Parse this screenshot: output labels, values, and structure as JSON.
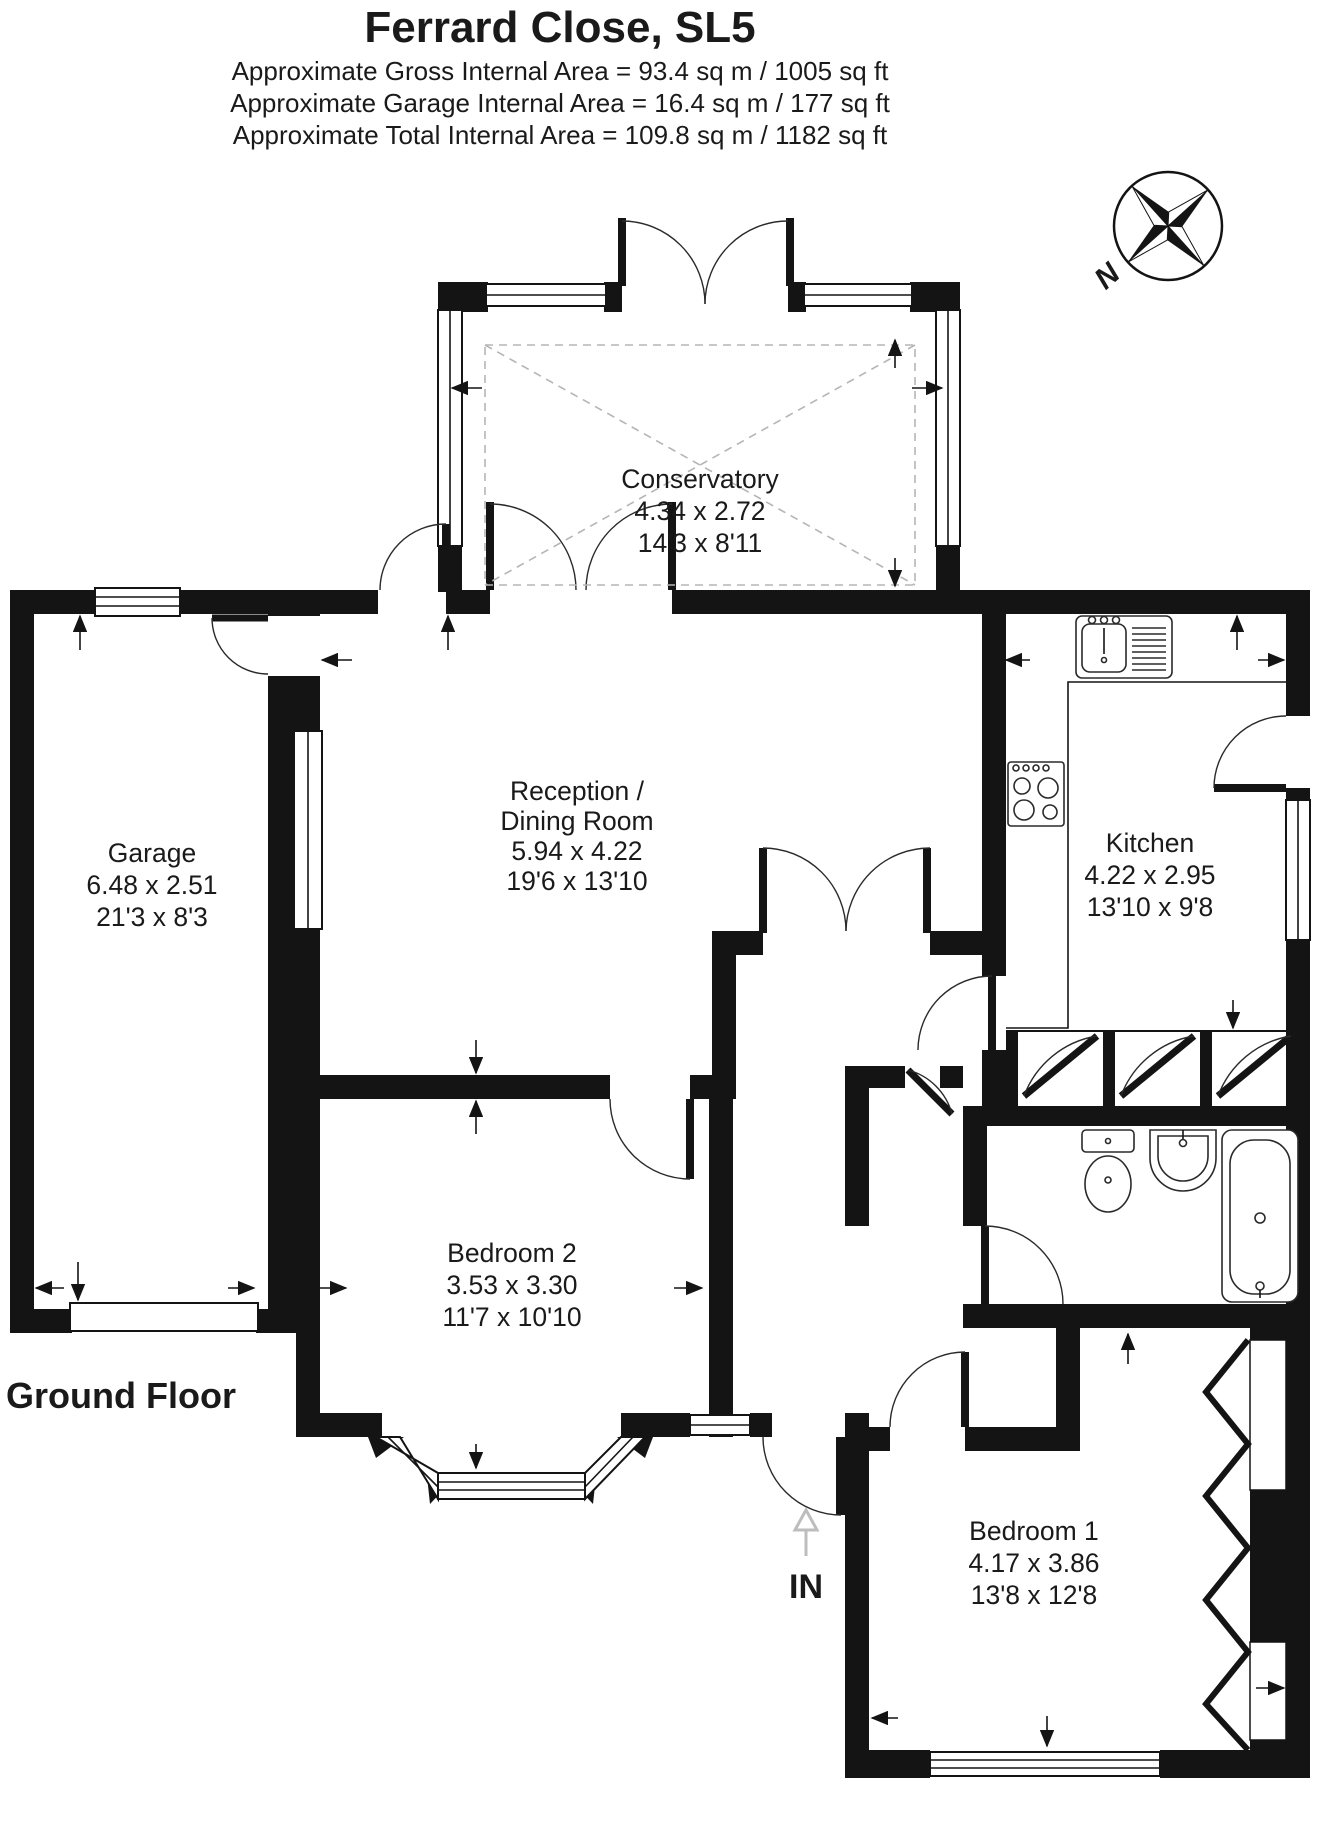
{
  "header": {
    "title": "Ferrard Close, SL5",
    "area_lines": [
      "Approximate Gross Internal Area = 93.4 sq m / 1005 sq ft",
      "Approximate Garage Internal Area = 16.4 sq m / 177 sq ft",
      "Approximate Total Internal Area = 109.8 sq m / 1182 sq ft"
    ]
  },
  "compass": {
    "north_label": "N"
  },
  "floor_label": "Ground Floor",
  "entrance_label": "IN",
  "rooms": {
    "conservatory": {
      "name": "Conservatory",
      "metric": "4.34 x 2.72",
      "imperial": "14'3 x 8'11"
    },
    "reception": {
      "name_line1": "Reception /",
      "name_line2": "Dining Room",
      "metric": "5.94 x 4.22",
      "imperial": "19'6 x 13'10"
    },
    "kitchen": {
      "name": "Kitchen",
      "metric": "4.22 x 2.95",
      "imperial": "13'10 x 9'8"
    },
    "garage": {
      "name": "Garage",
      "metric": "6.48 x 2.51",
      "imperial": "21'3 x 8'3"
    },
    "bedroom2": {
      "name": "Bedroom 2",
      "metric": "3.53 x 3.30",
      "imperial": "11'7 x 10'10"
    },
    "bedroom1": {
      "name": "Bedroom 1",
      "metric": "4.17 x 3.86",
      "imperial": "13'8 x 12'8"
    }
  },
  "colors": {
    "wall": "#141414",
    "roof_dash": "#b5b5b5",
    "entry_arrow": "#bdbdbd"
  }
}
